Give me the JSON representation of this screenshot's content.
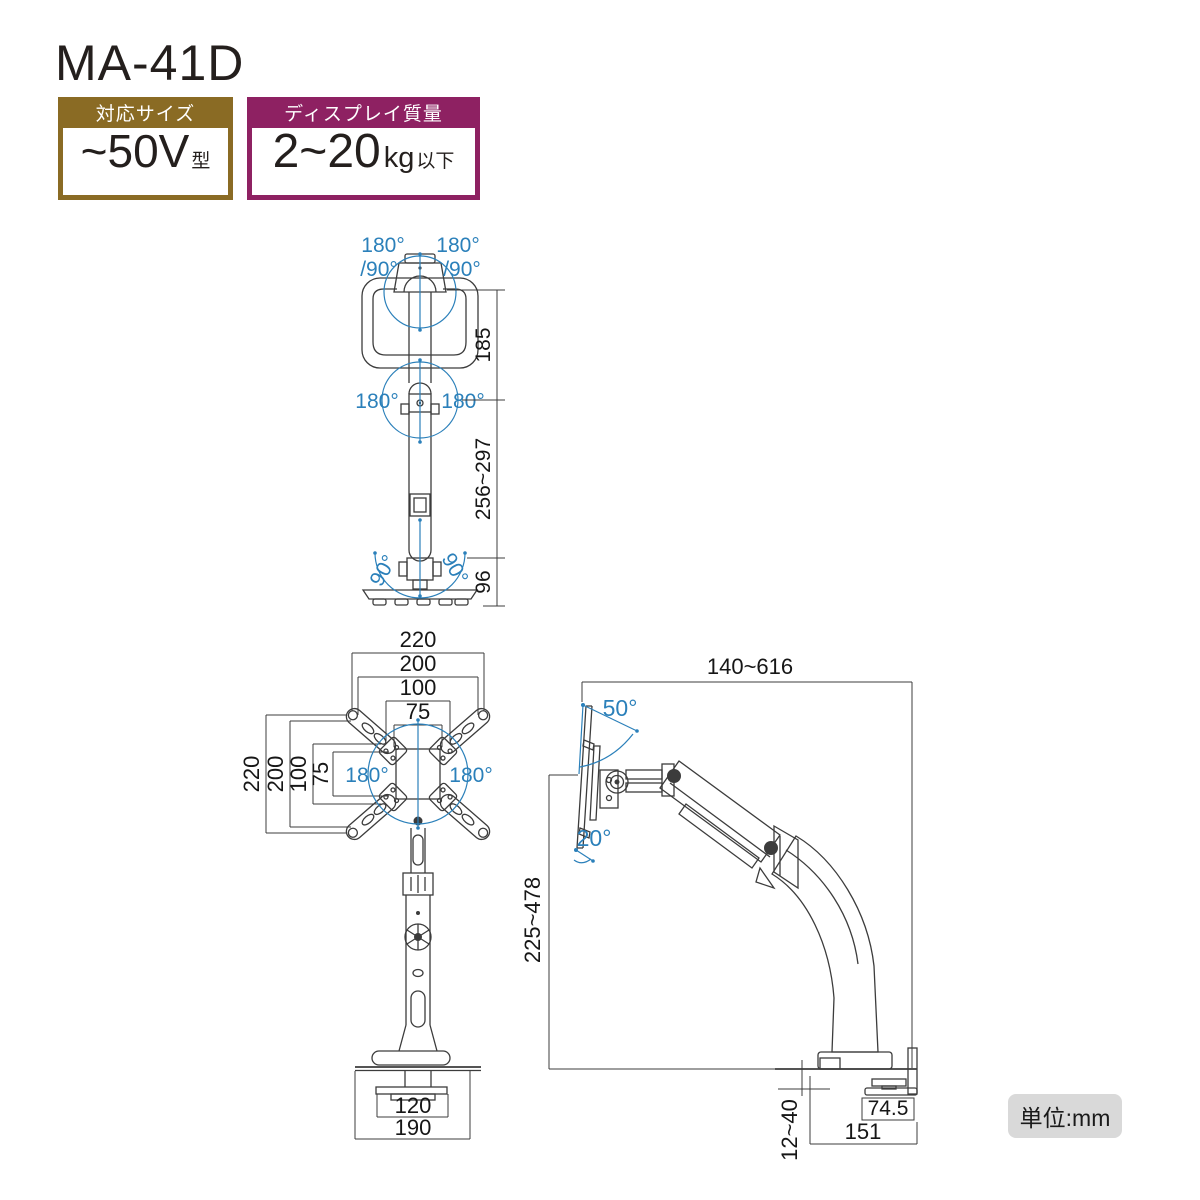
{
  "page": {
    "title": "MA-41D",
    "unit_label": "単位:mm"
  },
  "colors": {
    "accent_blue": "#2b80ba",
    "badge_brown": "#8a6b24",
    "badge_purple": "#8e2162",
    "line": "#3c3c3c",
    "unit_badge_bg": "#d9d9d9"
  },
  "badges": {
    "size": {
      "header": "対応サイズ",
      "value": "~50V",
      "suffix": "型"
    },
    "weight": {
      "header": "ディスプレイ質量",
      "value": "2~20",
      "unit": "kg",
      "suffix": "以下"
    }
  },
  "front_view": {
    "label_swivel_left": "180°",
    "label_swivel_right": "180°",
    "label_pivot_left": "/90°",
    "label_pivot_right": "/90°",
    "label_rotate_left": "180°",
    "label_rotate_right": "180°",
    "label_base_left": "90°",
    "label_base_right": "90°",
    "dim_top": "185",
    "dim_pole": "256~297",
    "dim_base": "96"
  },
  "vesa_view": {
    "dims_top": [
      "220",
      "200",
      "100",
      "75"
    ],
    "dims_left": [
      "220",
      "200",
      "100",
      "75"
    ],
    "label_rotate_left": "180°",
    "label_rotate_right": "180°",
    "dim_base_inner": "120",
    "dim_base_outer": "190"
  },
  "side_view": {
    "dim_reach": "140~616",
    "dim_height": "225~478",
    "label_tilt_up": "50°",
    "label_tilt_down": "20°",
    "dim_clamp_pad": "74.5",
    "dim_base_depth": "151",
    "dim_desk_thickness": "12~40"
  }
}
